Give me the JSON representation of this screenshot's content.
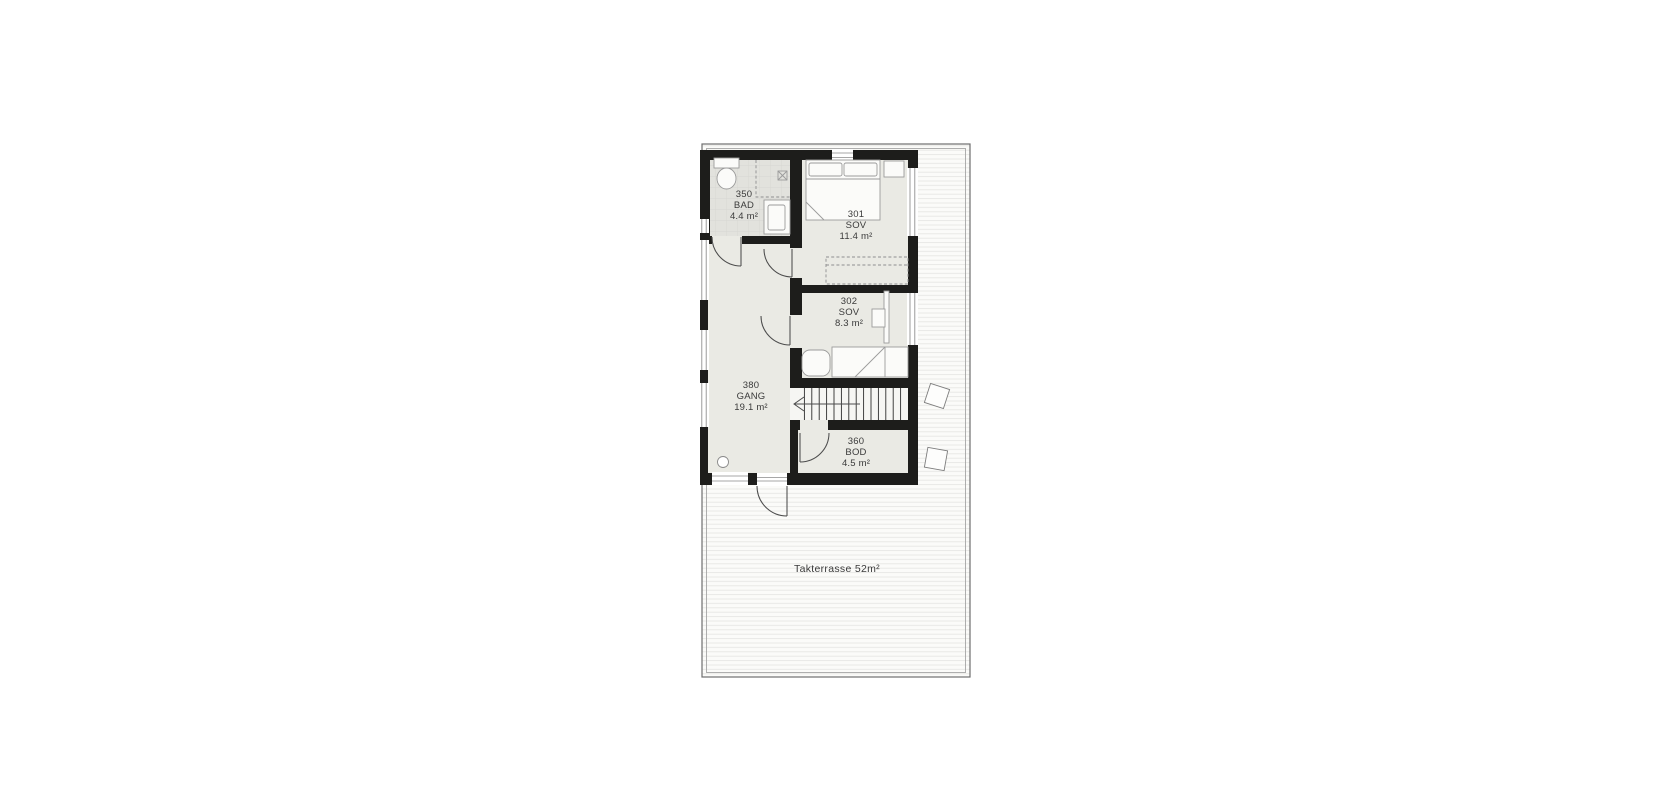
{
  "plan": {
    "rooms": [
      {
        "number": "350",
        "name": "BAD",
        "area": "4.4 m²"
      },
      {
        "number": "301",
        "name": "SOV",
        "area": "11.4 m²"
      },
      {
        "number": "302",
        "name": "SOV",
        "area": "8.3 m²"
      },
      {
        "number": "380",
        "name": "GANG",
        "area": "19.1 m²"
      },
      {
        "number": "360",
        "name": "BOD",
        "area": "4.5 m²"
      }
    ],
    "terrace": {
      "label": "Takterrasse 52m²"
    },
    "colors": {
      "wall": "#1d1d1b",
      "room_floor": "#eaeae4",
      "bath_floor": "#e2e2dd",
      "stairs_floor": "#f6f6f3"
    }
  }
}
